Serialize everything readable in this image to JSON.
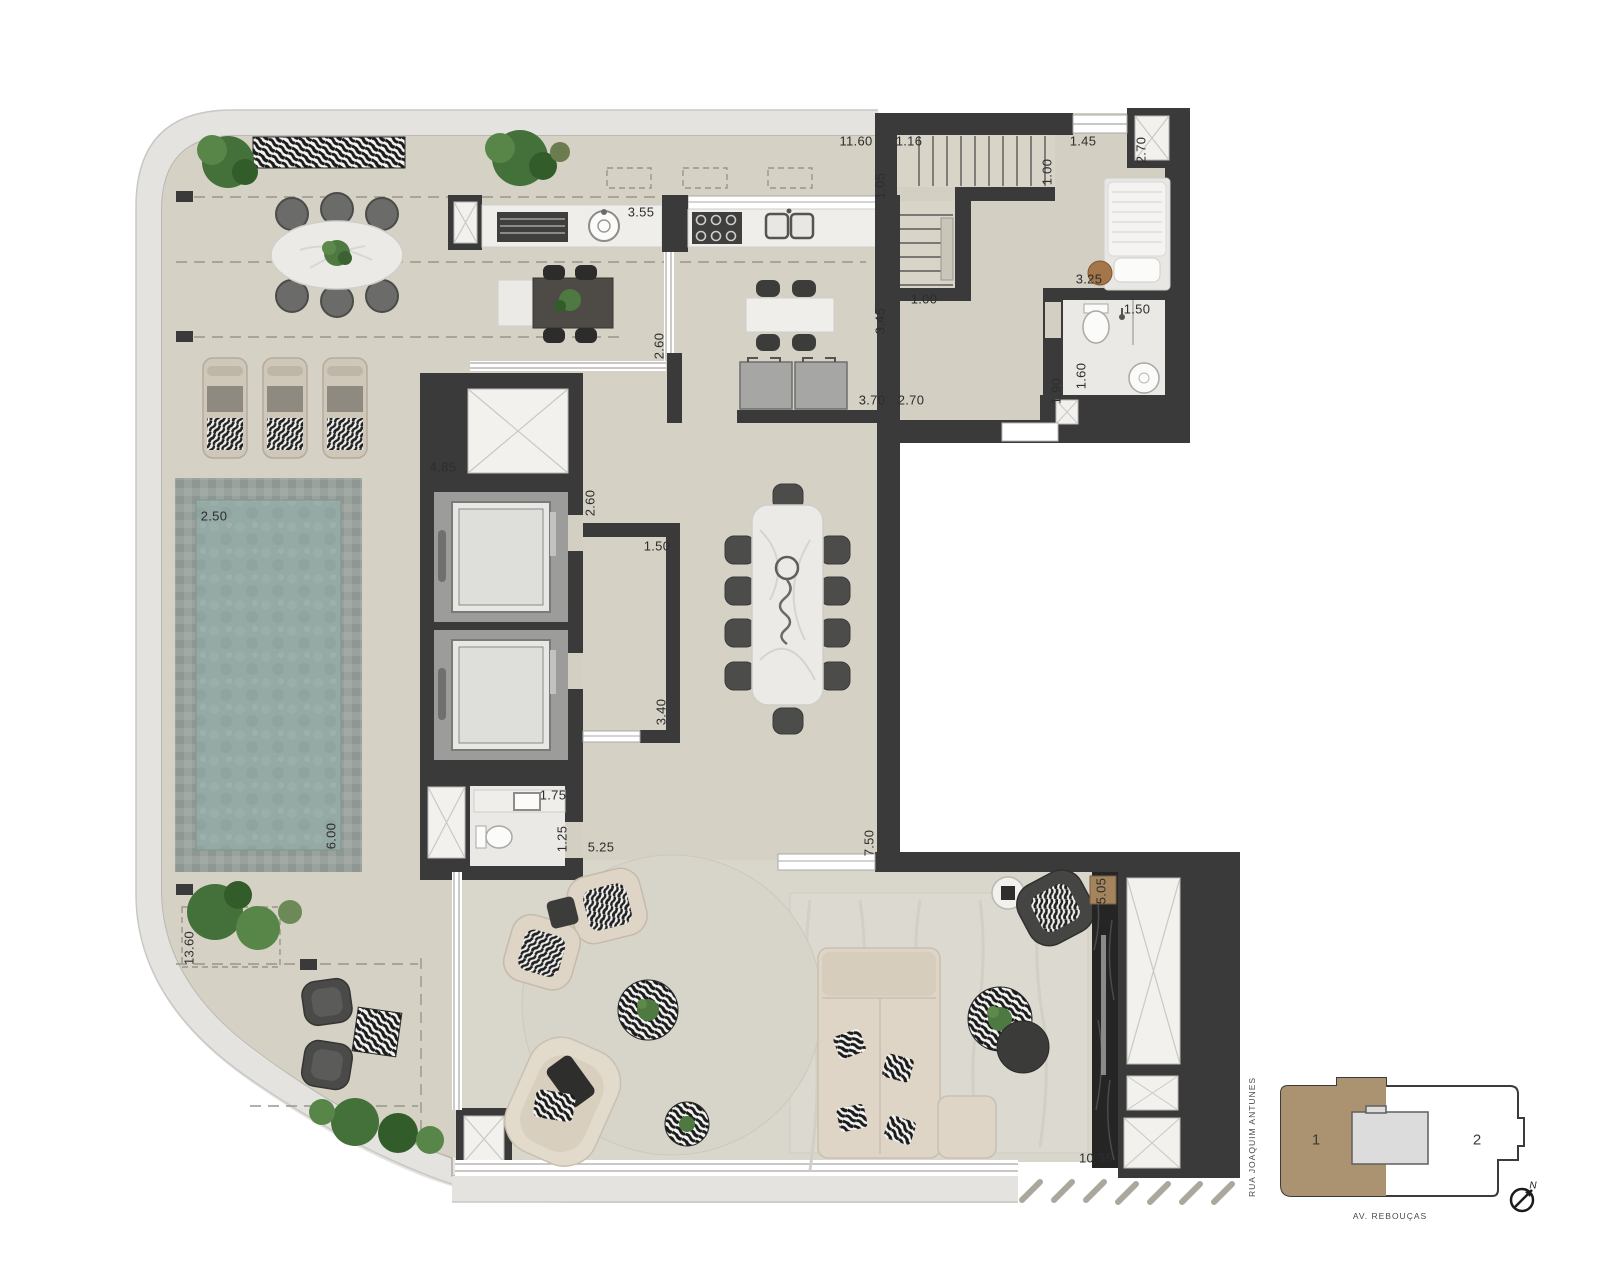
{
  "plan_title": "Penthouse floor plan",
  "dims": [
    "11.60",
    "1.16",
    "1.45",
    "2.70",
    "1.05",
    "1.00",
    "3.55",
    "3.45",
    "1.00",
    "3.25",
    "1.50",
    "1.60",
    "1.90",
    "3.70",
    "2.70",
    "2.60",
    "4.85",
    "2.60",
    "1.50",
    "3.40",
    "2.50",
    "6.00",
    "1.75",
    "1.25",
    "5.25",
    "7.50",
    "13.60",
    "5.05",
    "10.35"
  ],
  "key_plan": {
    "unit1_label": "1",
    "unit2_label": "2",
    "street_left": "RUA JOAQUIM ANTUNES",
    "street_bottom": "AV. REBOUÇAS",
    "north_label": "N",
    "unit1_color": "#ab9371"
  },
  "colors": {
    "wall": "#3a3a3a",
    "terrace_floor": "#d5d1c4",
    "living_floor": "#d9d6cc",
    "bath_floor": "#eae9e5",
    "pool_water": "#95a9a5",
    "marble": "#efeeea",
    "sofa": "#ded5c6",
    "sidewalk_band": "#e4e3df"
  }
}
